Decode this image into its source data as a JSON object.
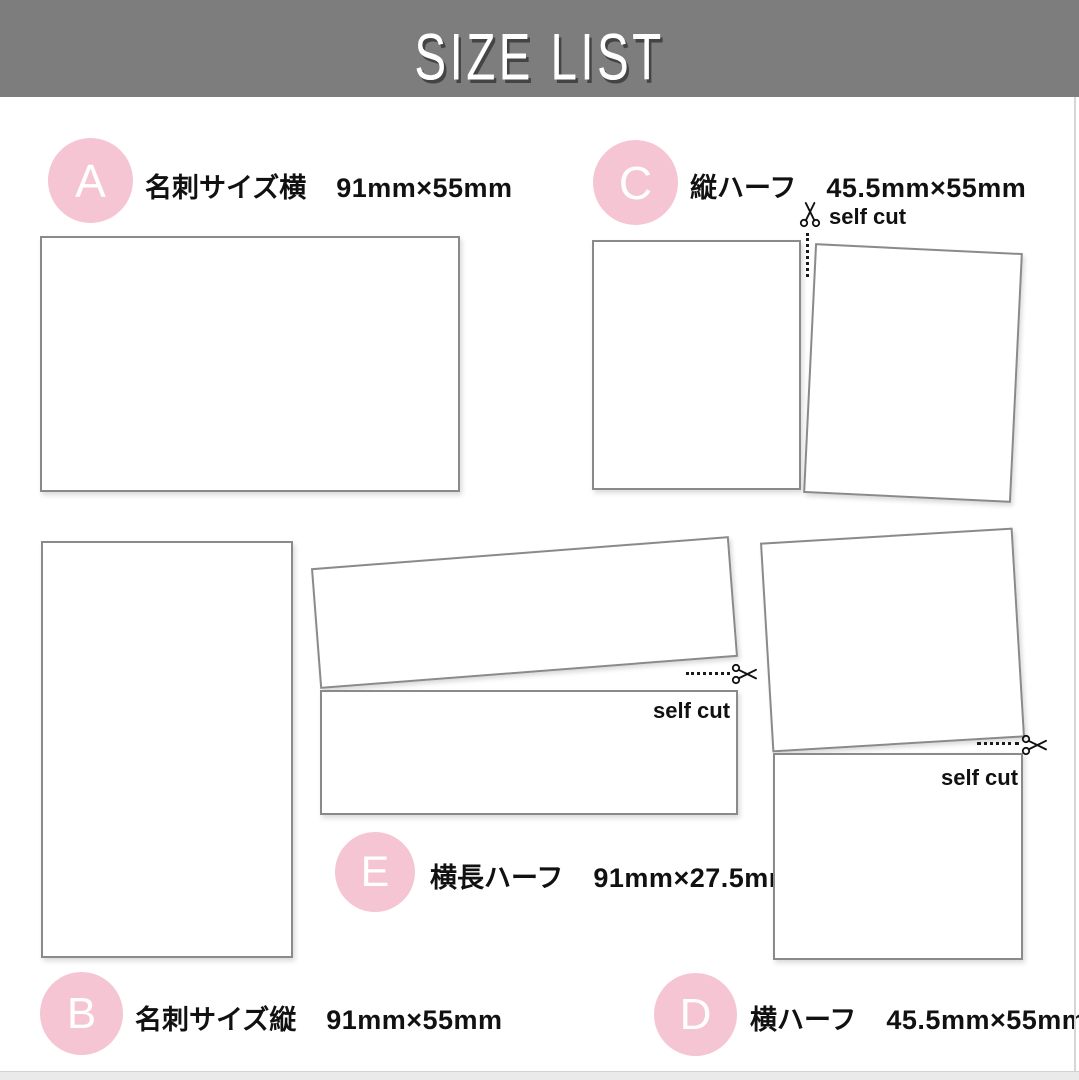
{
  "header": {
    "title": "SIZE LIST"
  },
  "colors": {
    "header_bg": "#7d7d7d",
    "title_text": "#ffffff",
    "badge_pink": "#f6c5d3",
    "badge_letter": "#ffffff",
    "card_border": "#8a8a8a",
    "text": "#111111"
  },
  "items": {
    "A": {
      "letter": "A",
      "name": "名刺サイズ横",
      "size": "91mm×55mm"
    },
    "B": {
      "letter": "B",
      "name": "名刺サイズ縦",
      "size": "91mm×55mm"
    },
    "C": {
      "letter": "C",
      "name": "縦ハーフ",
      "size": "45.5mm×55mm",
      "cut_label": "self cut"
    },
    "D": {
      "letter": "D",
      "name": "横ハーフ",
      "size": "45.5mm×55mm",
      "cut_label": "self cut"
    },
    "E": {
      "letter": "E",
      "name": "横長ハーフ",
      "size": "91mm×27.5mm",
      "cut_label": "self cut"
    }
  }
}
